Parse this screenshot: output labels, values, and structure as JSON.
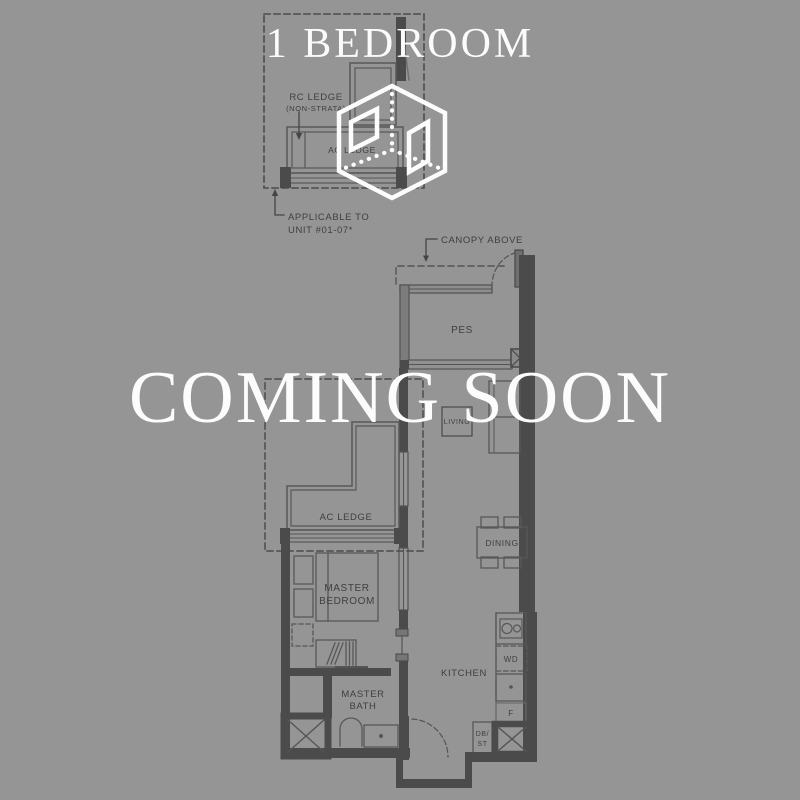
{
  "title": "1 BEDROOM",
  "watermark": "COMING SOON",
  "colors": {
    "background": "#959595",
    "wall": "#4b4b4b",
    "line": "#575757",
    "label": "#3f3f3f",
    "white": "#fcfcfc"
  },
  "icons": {
    "logo": "isometric-cube-logo"
  },
  "inset": {
    "rc_ledge": "RC LEDGE",
    "rc_ledge_note": "(NON-STRATA)",
    "ac_ledge": "AC LEDGE",
    "applicable_1": "APPLICABLE TO",
    "applicable_2": "UNIT #01-07*"
  },
  "plan": {
    "canopy": "CANOPY ABOVE",
    "pes": "PES",
    "living": "LIVING",
    "dining": "DINING",
    "ac_ledge": "AC LEDGE",
    "master_bedroom_1": "MASTER",
    "master_bedroom_2": "BEDROOM",
    "master_bath_1": "MASTER",
    "master_bath_2": "BATH",
    "kitchen": "KITCHEN",
    "washer_dryer": "WD",
    "fridge": "F",
    "db_1": "DB/",
    "db_2": "ST"
  }
}
